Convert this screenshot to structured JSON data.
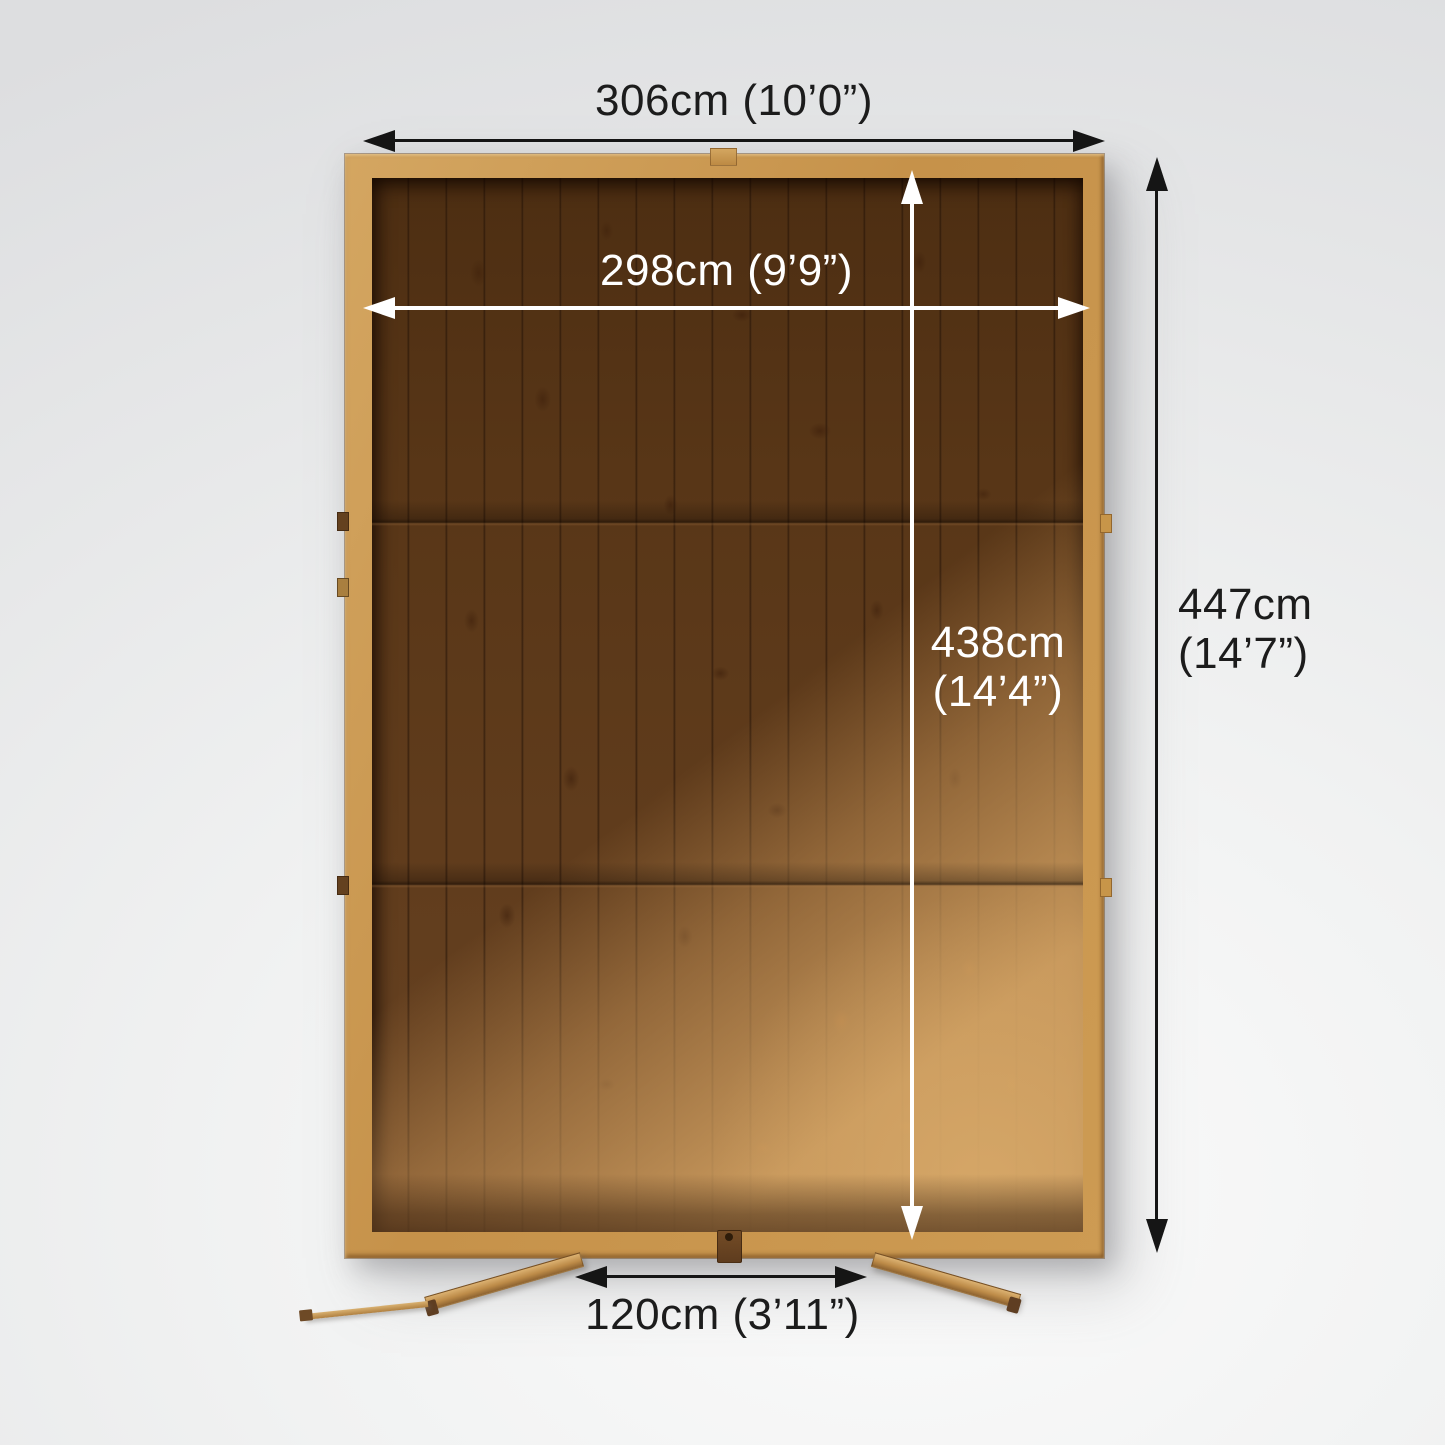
{
  "diagram": {
    "title": "shed-floor-plan-top-view",
    "labels": {
      "external_width": "306cm (10’0”)",
      "internal_width": "298cm (9’9”)",
      "internal_depth_value": "438cm",
      "internal_depth_imperial": "(14’4”)",
      "external_depth_value": "447cm",
      "external_depth_imperial": "(14’7”)",
      "door_width": "120cm (3’11”)"
    },
    "values_cm": {
      "external_width": 306,
      "internal_width": 298,
      "internal_depth": 438,
      "external_depth": 447,
      "door_width": 120
    },
    "colors": {
      "dimension_dark": "#1c1c1c",
      "dimension_light": "#ffffff",
      "wood_frame": "#c9964f",
      "wood_floor_dark": "#58361a",
      "wood_floor_light": "#c09058",
      "background": "#eceded"
    }
  }
}
